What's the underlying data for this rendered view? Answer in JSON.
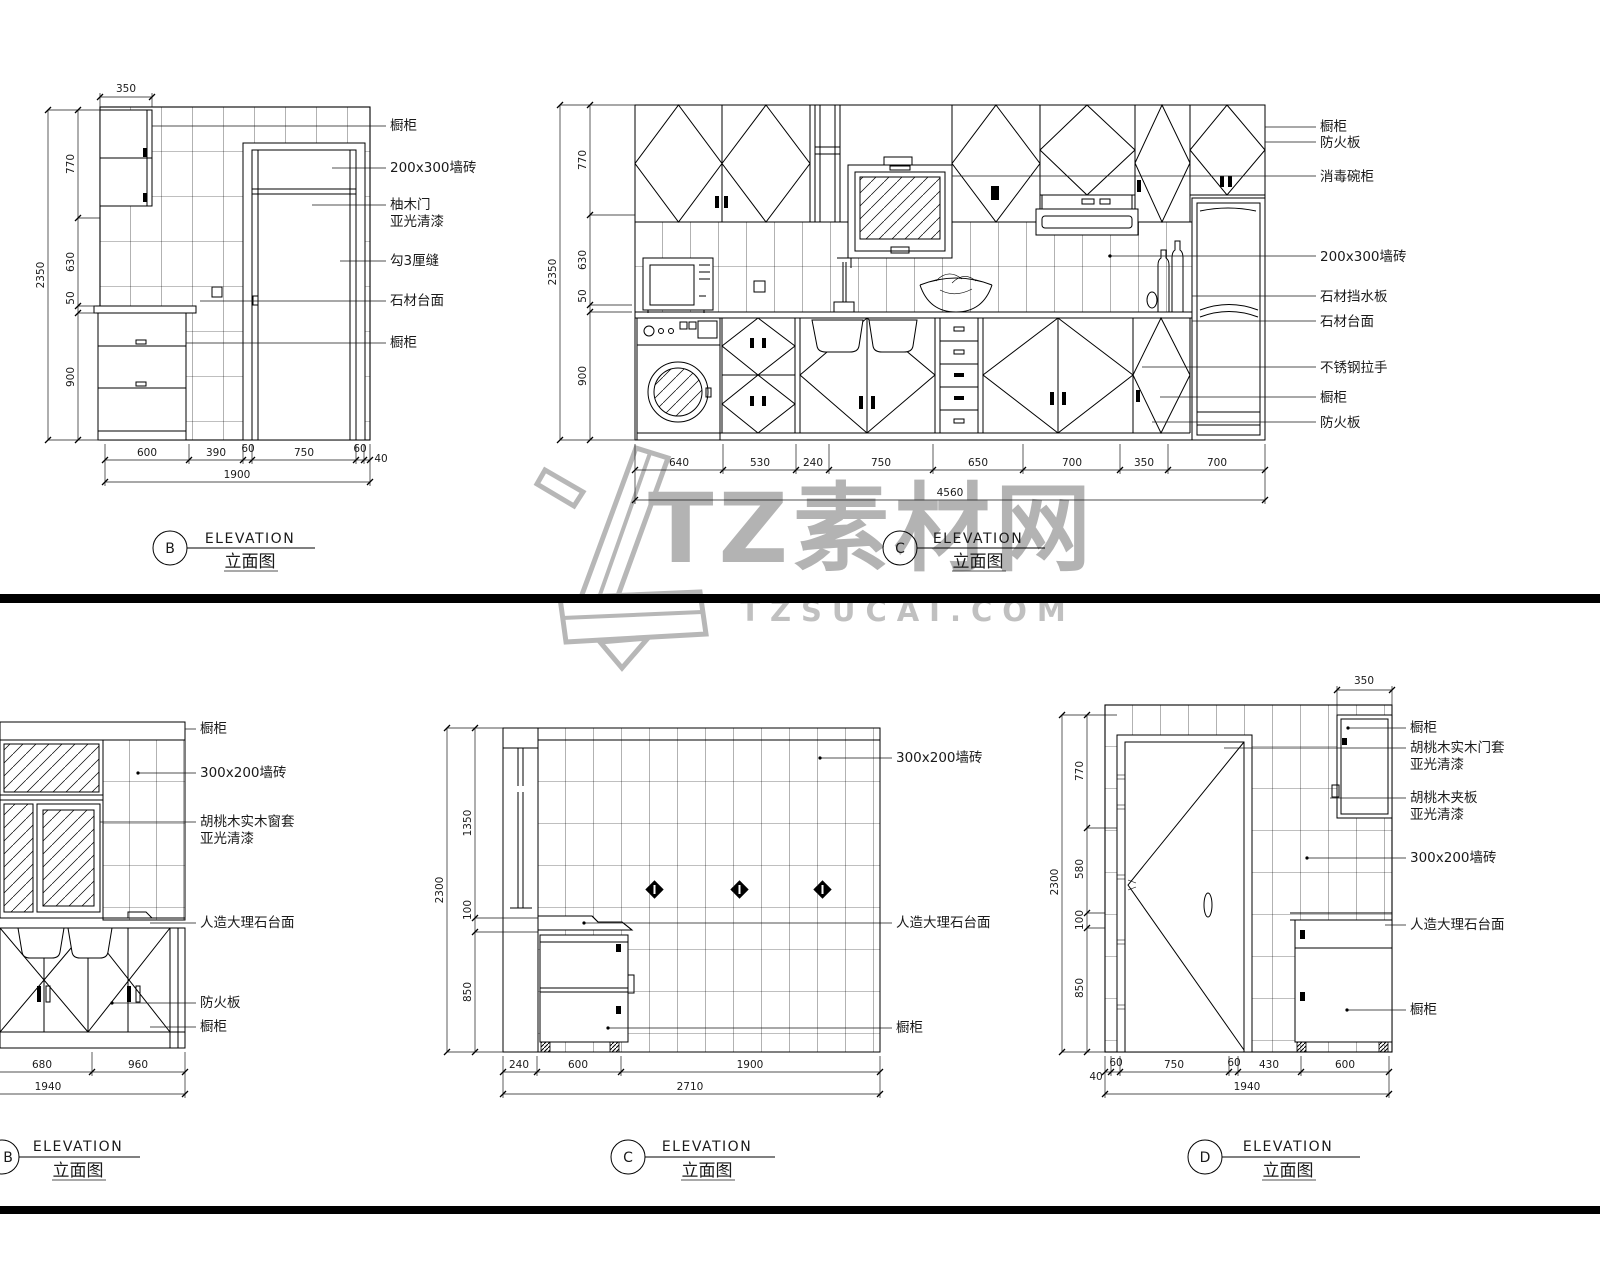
{
  "watermark": {
    "brand": "TZ素材网",
    "domain": "TZSUCAI.COM"
  },
  "top_b": {
    "title": {
      "letter": "B",
      "en": "ELEVATION",
      "zh": "立面图"
    },
    "labels": [
      "橱柜",
      "200x300墙砖",
      "柚木门",
      "亚光清漆",
      "勾3厘缝",
      "石材台面",
      "橱柜"
    ],
    "vdims": {
      "segments": [
        "770",
        "630",
        "50",
        "900"
      ],
      "total": "2350"
    },
    "hdims": {
      "segments": [
        "600",
        "390",
        "60",
        "750",
        "60",
        "40"
      ],
      "total": "1900"
    },
    "top_dim": "350"
  },
  "top_c": {
    "title": {
      "letter": "C",
      "en": "ELEVATION",
      "zh": "立面图"
    },
    "labels": [
      "橱柜",
      "防火板",
      "消毒碗柜",
      "200x300墙砖",
      "石材挡水板",
      "石材台面",
      "不锈钢拉手",
      "橱柜",
      "防火板"
    ],
    "vdims": {
      "segments": [
        "770",
        "630",
        "50",
        "900"
      ],
      "total": "2350"
    },
    "hdims": {
      "segments": [
        "640",
        "530",
        "240",
        "750",
        "650",
        "700",
        "350",
        "700"
      ],
      "total": "4560"
    }
  },
  "bot_b": {
    "title": {
      "letter": "B",
      "en": "ELEVATION",
      "zh": "立面图"
    },
    "labels": [
      "橱柜",
      "300x200墙砖",
      "胡桃木实木窗套",
      "亚光清漆",
      "人造大理石台面",
      "防火板",
      "橱柜"
    ],
    "hdims": {
      "segments": [
        "680",
        "960"
      ],
      "total": "1940"
    }
  },
  "bot_c": {
    "title": {
      "letter": "C",
      "en": "ELEVATION",
      "zh": "立面图"
    },
    "labels": [
      "300x200墙砖",
      "人造大理石台面",
      "橱柜"
    ],
    "vdims": {
      "segments": [
        "1350",
        "100",
        "850"
      ],
      "total": "2300"
    },
    "hdims": {
      "segments": [
        "240",
        "600",
        "1900"
      ],
      "total": "2710"
    }
  },
  "bot_d": {
    "title": {
      "letter": "D",
      "en": "ELEVATION",
      "zh": "立面图"
    },
    "labels": [
      "橱柜",
      "胡桃木实木门套",
      "亚光清漆",
      "胡桃木夹板",
      "亚光清漆",
      "300x200墙砖",
      "人造大理石台面",
      "橱柜"
    ],
    "vdims": {
      "segments": [
        "770",
        "580",
        "100",
        "850"
      ],
      "total": "2300"
    },
    "hdims": {
      "segments": [
        "40",
        "60",
        "750",
        "60",
        "430",
        "600"
      ],
      "total": "1940"
    },
    "top_dim": "350"
  }
}
